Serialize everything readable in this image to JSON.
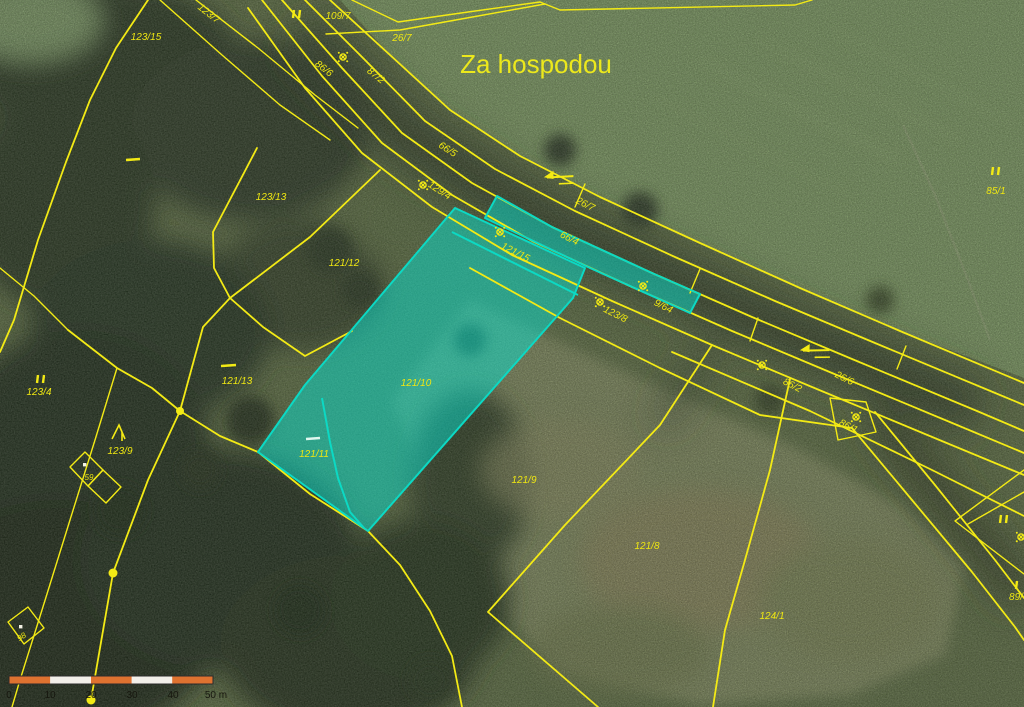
{
  "map": {
    "place_label": "Za hospodou",
    "colors": {
      "boundary_line": "#f3ea15",
      "parcel_label": "#efe712",
      "highlight_fill": "#02e8d6",
      "highlight_stroke": "#0cd9c4",
      "scale_bar_orange": "#de7230",
      "scale_bar_white": "#f2efe9"
    },
    "highlighted_parcels": [
      "66/4",
      "121/15",
      "121/10",
      "121/11"
    ],
    "labels": [
      {
        "id": "p123-15",
        "text": "123/15"
      },
      {
        "id": "p123-7",
        "text": "123/7"
      },
      {
        "id": "p109-7",
        "text": "109/7"
      },
      {
        "id": "p26-7a",
        "text": "26/7"
      },
      {
        "id": "p86-6",
        "text": "86/6"
      },
      {
        "id": "p87-2",
        "text": "87/2"
      },
      {
        "id": "p66-5",
        "text": "66/5"
      },
      {
        "id": "p129-4",
        "text": "129/4"
      },
      {
        "id": "p26-7b",
        "text": "26/7"
      },
      {
        "id": "p66-4",
        "text": "66/4"
      },
      {
        "id": "p121-15",
        "text": "121/15"
      },
      {
        "id": "p9-64",
        "text": "9/64"
      },
      {
        "id": "p123-8",
        "text": "123/8"
      },
      {
        "id": "p26-6",
        "text": "26/6"
      },
      {
        "id": "p86-2",
        "text": "86/2"
      },
      {
        "id": "p86-1",
        "text": "86/1"
      },
      {
        "id": "p123-13",
        "text": "123/13"
      },
      {
        "id": "p121-12",
        "text": "121/12"
      },
      {
        "id": "p121-13",
        "text": "121/13"
      },
      {
        "id": "p123-4",
        "text": "123/4"
      },
      {
        "id": "p123-9",
        "text": "123/9"
      },
      {
        "id": "p59",
        "text": "59"
      },
      {
        "id": "p98",
        "text": "98"
      },
      {
        "id": "p121-10",
        "text": "121/10"
      },
      {
        "id": "p121-11",
        "text": "121/11"
      },
      {
        "id": "p121-9",
        "text": "121/9"
      },
      {
        "id": "p121-8",
        "text": "121/8"
      },
      {
        "id": "p124-1",
        "text": "124/1"
      },
      {
        "id": "p85-1",
        "text": "85/1"
      },
      {
        "id": "p89",
        "text": "89/"
      }
    ],
    "symbols": [
      "cadastral-point-icon",
      "grassland-bars-icon",
      "grassland-dash-icon",
      "slope-peak-icon",
      "direction-arrow-icon",
      "boundary-vertex-dot",
      "building-dot"
    ]
  },
  "scale_bar": {
    "ticks": [
      "0",
      "10",
      "20",
      "30",
      "40",
      "50 m"
    ]
  }
}
